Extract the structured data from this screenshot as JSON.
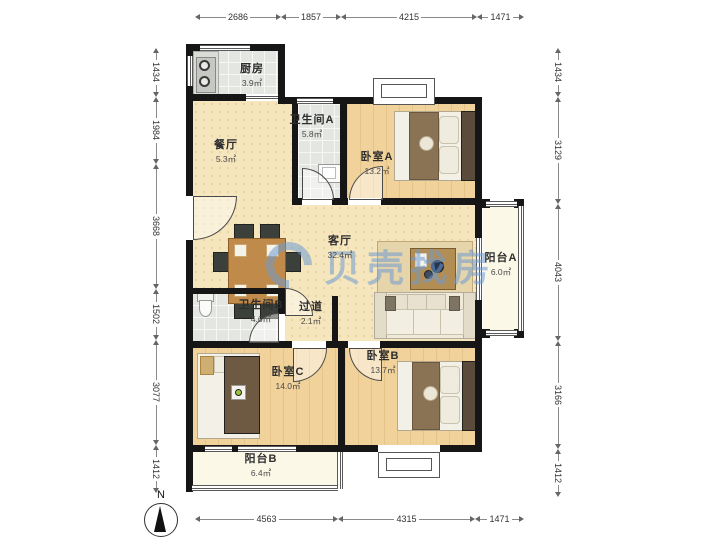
{
  "rooms": {
    "kitchen": {
      "name": "厨房",
      "area": "3.9㎡"
    },
    "dining": {
      "name": "餐厅",
      "area": "5.3㎡"
    },
    "bath_a": {
      "name": "卫生间A",
      "area": "5.8㎡"
    },
    "bedroom_a": {
      "name": "卧室A",
      "area": "13.2㎡"
    },
    "living": {
      "name": "客厅",
      "area": "32.4㎡"
    },
    "balcony_a": {
      "name": "阳台A",
      "area": "6.0㎡"
    },
    "bath_b": {
      "name": "卫生间B",
      "area": "4.6㎡"
    },
    "hallway": {
      "name": "过道",
      "area": "2.1㎡"
    },
    "bedroom_c": {
      "name": "卧室C",
      "area": "14.0㎡"
    },
    "bedroom_b": {
      "name": "卧室B",
      "area": "13.7㎡"
    },
    "balcony_b": {
      "name": "阳台B",
      "area": "6.4㎡"
    }
  },
  "dimensions_mm": {
    "top": [
      "2686",
      "1857",
      "4215",
      "1471"
    ],
    "bottom": [
      "4563",
      "4315",
      "1471"
    ],
    "left": [
      "1434",
      "1984",
      "3668",
      "1502",
      "3077",
      "1412"
    ],
    "right": [
      "1434",
      "3129",
      "4043",
      "3166",
      "1412"
    ]
  },
  "compass": {
    "label": "N"
  },
  "watermark": {
    "text": "贝壳找房"
  },
  "colors": {
    "wall": "#161616",
    "wood_floor": "#f0d29a",
    "living_floor": "#f6e6bd",
    "tile_floor": "#e4e6e1",
    "balcony_floor": "#fbf8e8",
    "watermark_blue": "#6d9bd2"
  }
}
